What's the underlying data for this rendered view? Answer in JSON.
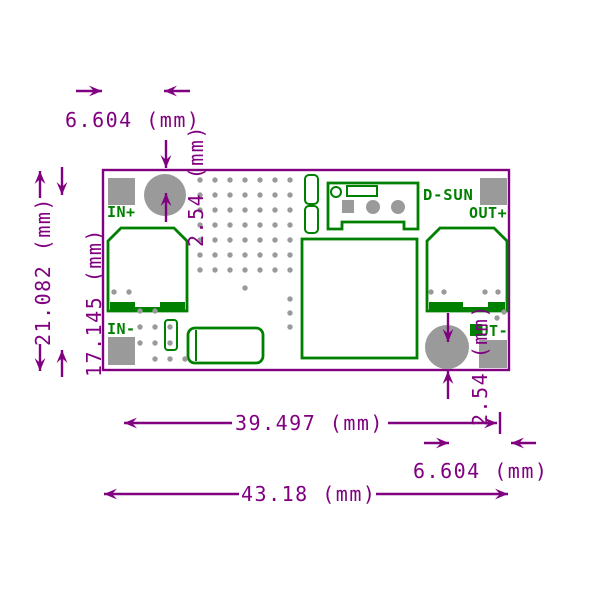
{
  "title": "PCB module dimension drawing",
  "colors": {
    "dimension": "#800080",
    "silkscreen": "#008000",
    "pad": "#9a9a9a",
    "board": "#ffffff"
  },
  "dimensions": {
    "top_hole_x_offset": "6.604 (mm)",
    "top_hole_y_offset": "2.54 (mm)",
    "board_height": "21.082 (mm)",
    "inner_height": "17.145 (mm)",
    "hole_span_width": "39.497 (mm)",
    "board_width": "43.18 (mm)",
    "bottom_hole_x_offset": "6.604 (mm)",
    "bottom_hole_y_offset": "2.54 (mm)"
  },
  "labels": {
    "brand": "D-SUN",
    "in_plus": "IN+",
    "in_minus": "IN-",
    "out_plus": "OUT+",
    "out_minus": "OUT-"
  },
  "vias": {
    "grid": {
      "x0": 200,
      "y0": 180,
      "dx": 15,
      "dy": 15,
      "cols": 7,
      "rows": 7
    },
    "extra": [
      [
        245,
        288
      ],
      [
        290,
        299
      ],
      [
        290,
        313
      ],
      [
        290,
        327
      ],
      [
        114,
        292
      ],
      [
        129,
        292
      ],
      [
        140,
        311
      ],
      [
        155,
        311
      ],
      [
        140,
        327
      ],
      [
        155,
        327
      ],
      [
        170,
        327
      ],
      [
        140,
        343
      ],
      [
        155,
        343
      ],
      [
        170,
        343
      ],
      [
        155,
        359
      ],
      [
        170,
        359
      ],
      [
        185,
        359
      ],
      [
        431,
        292
      ],
      [
        444,
        292
      ],
      [
        485,
        292
      ],
      [
        498,
        292
      ],
      [
        497,
        318
      ],
      [
        504,
        312
      ]
    ]
  }
}
